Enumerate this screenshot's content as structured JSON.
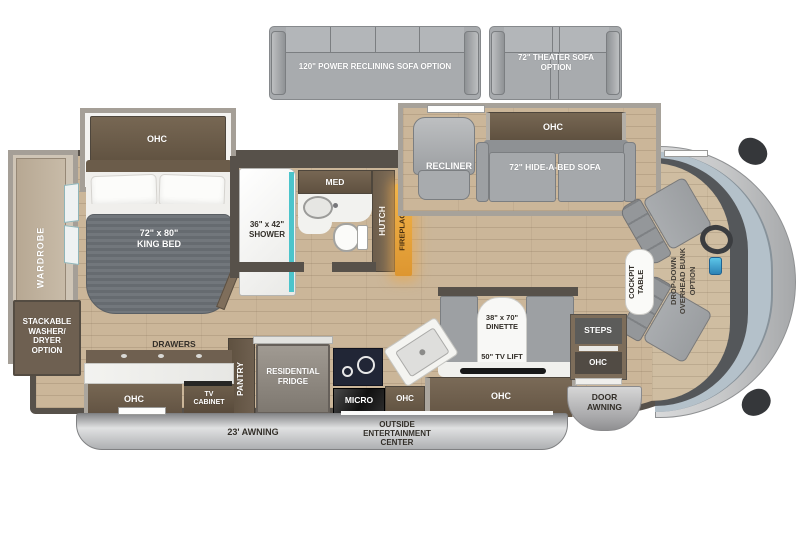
{
  "diagram_type": "RV motorhome floor plan",
  "colors": {
    "floor_wood": "#cbb699",
    "wall": "#57514a",
    "cabinet_wood": "#6f6050",
    "slide_frame": "#a59f97",
    "sofa_gray": "#a0a3a6",
    "mattress_gray": "#6e7377",
    "shower_glass_teal": "#4cc4cb",
    "fireplace_orange": "#e8a23c",
    "windshield_blue": "#b4c1ca",
    "awning_gray": "#b5b6b8",
    "counter_white": "#f2f2ef"
  },
  "options": {
    "power_sofa": "120\" POWER RECLINING SOFA OPTION",
    "theater_sofa": "72\" THEATER SOFA\nOPTION"
  },
  "bedroom": {
    "ohc": "OHC",
    "king_bed": "72\" x 80\"\nKING BED",
    "wardrobe": "WARDROBE",
    "washer_dryer": "STACKABLE\nWASHER/\nDRYER\nOPTION",
    "drawers": "DRAWERS",
    "dresser_ohc": "OHC",
    "tv_cabinet": "TV\nCABINET"
  },
  "bathroom": {
    "shower": "36\" x 42\"\nSHOWER",
    "med": "MED",
    "hutch": "HUTCH"
  },
  "living": {
    "fireplace": "FIREPLACE",
    "recliner": "RECLINER",
    "sofa_ohc": "OHC",
    "hide_a_bed": "72\" HIDE-A-BED SOFA",
    "dinette": "38\" x 70\"\nDINETTE",
    "tv_lift": "50\" TV LIFT",
    "dinette_ohc": "OHC"
  },
  "kitchen": {
    "pantry": "PANTRY",
    "fridge": "RESIDENTIAL\nFRIDGE",
    "micro": "MICRO",
    "ohc": "OHC"
  },
  "entry": {
    "steps": "STEPS",
    "ohc": "OHC",
    "door_awning": "DOOR\nAWNING"
  },
  "cockpit": {
    "table": "COCKPIT\nTABLE",
    "bunk_option": "DROP-DOWN\nOVERHEAD BUNK\nOPTION"
  },
  "exterior": {
    "awning": "23' AWNING",
    "entertainment_center": "OUTSIDE\nENTERTAINMENT\nCENTER"
  }
}
